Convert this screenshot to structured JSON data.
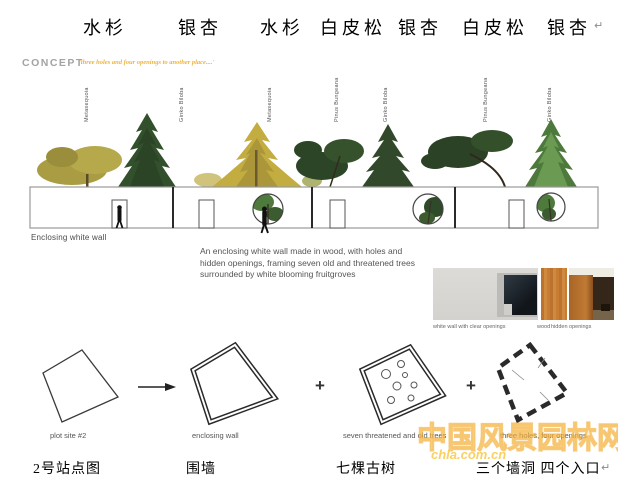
{
  "top_row": {
    "labels": [
      {
        "text": "水杉"
      },
      {
        "text": "银杏"
      },
      {
        "text": "水杉"
      },
      {
        "text": "白皮松"
      },
      {
        "text": "银杏"
      },
      {
        "text": "白皮松"
      },
      {
        "text": "银杏"
      }
    ],
    "return_mark": "↵"
  },
  "concept": {
    "heading": "CONCEPT",
    "tagline": "'three holes and four openings to another place....'"
  },
  "species_labels": [
    {
      "name": "Metasequoia"
    },
    {
      "name": "Ginko Biloba"
    },
    {
      "name": "Metasequoia"
    },
    {
      "name": "Pinus Bungeana"
    },
    {
      "name": "Ginko Biloba"
    },
    {
      "name": "Pinus Bungeana"
    },
    {
      "name": "Ginko Biloba"
    }
  ],
  "wall": {
    "caption": "Enclosing white wall"
  },
  "description": "An enclosing white wall made in wood, with holes and hidden openings, framing seven old and threatened trees surrounded by white blooming fruitgroves",
  "photos": {
    "captions": [
      "white wall with clear openings",
      "wood",
      "hidden openings"
    ]
  },
  "diagrams": {
    "plus": "+",
    "labels": [
      "plot site #2",
      "enclosing wall",
      "seven threatened and old trees",
      "three holes, four openings"
    ]
  },
  "bottom_row": {
    "labels": [
      "2号站点图",
      "围墙",
      "七棵古树",
      "三个墙洞  四个入口"
    ],
    "return_mark": "↵"
  },
  "watermark": {
    "cn": "中国风景园林网",
    "en": "chla.com.cn"
  },
  "colors": {
    "accent_orange": "#eeb43c",
    "tree_dark_green": "#33502c",
    "tree_gold": "#c3ac40",
    "wood": "#c07a35"
  }
}
